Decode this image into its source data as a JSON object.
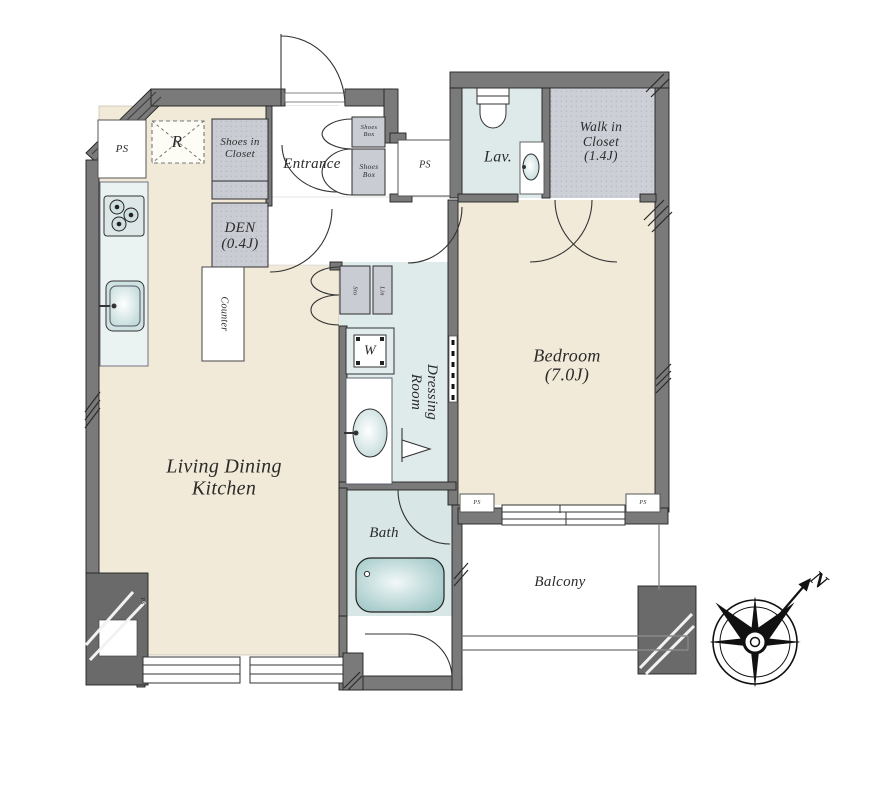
{
  "rooms": {
    "living": {
      "line1": "Living Dining",
      "line2": "Kitchen"
    },
    "bedroom": {
      "name": "Bedroom",
      "size": "(7.0J)"
    },
    "entrance": {
      "name": "Entrance"
    },
    "den": {
      "name": "DEN",
      "size": "(0.4J)"
    },
    "walk_in_closet": {
      "line1": "Walk in",
      "line2": "Closet",
      "size": "(1.4J)"
    },
    "lavatory": {
      "name": "Lav."
    },
    "bath": {
      "name": "Bath"
    },
    "balcony": {
      "name": "Balcony"
    },
    "dressing": {
      "line1": "Dressing",
      "line2": "Room"
    }
  },
  "fixtures": {
    "refrigerator": "R",
    "washer": "W",
    "counter": "Counter",
    "shoes_closet": {
      "line1": "Shoes in",
      "line2": "Closet"
    },
    "shoes_box_upper": {
      "line1": "Shoes",
      "line2": "Box"
    },
    "shoes_box_lower": {
      "line1": "Shoes",
      "line2": "Box"
    },
    "storage": "Sto",
    "linen": "Lin"
  },
  "annotations": {
    "pipe_space": "PS",
    "north": "N"
  },
  "colors": {
    "wall": "#7a7a7a",
    "pillar": "#6a6a6a",
    "floor": "#f1ead8",
    "wet": "#dde9e9",
    "closet": "#caccd4",
    "tub": "#a5cbcb",
    "line": "#222222"
  }
}
